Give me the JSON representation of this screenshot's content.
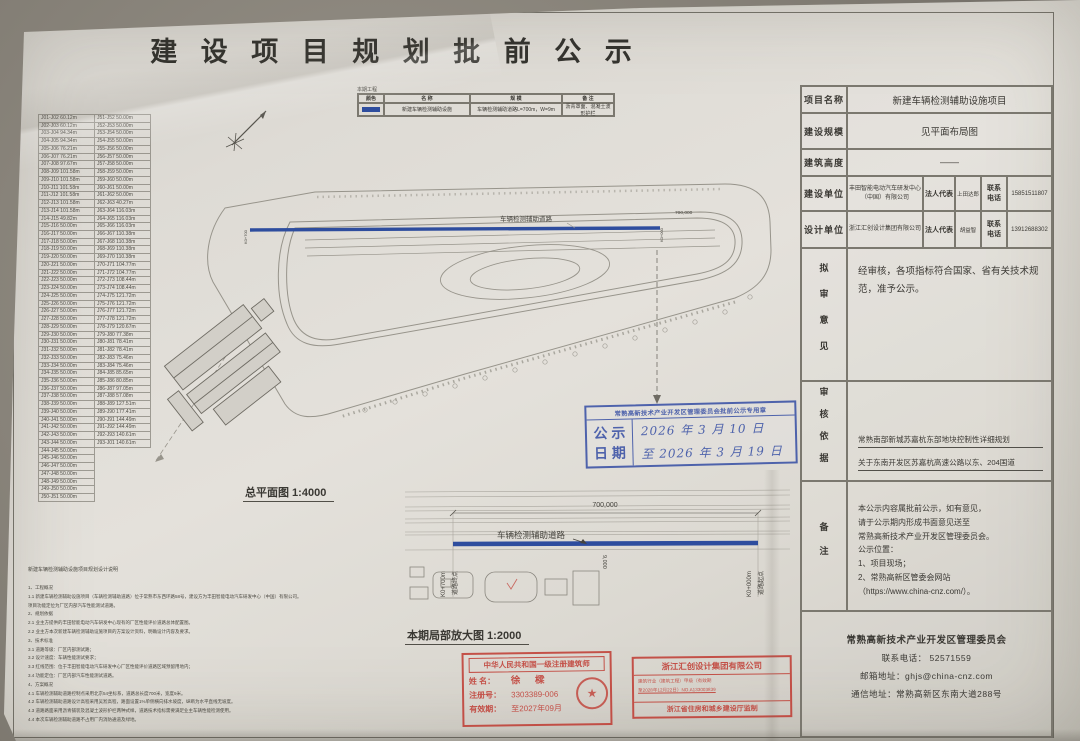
{
  "page": {
    "title": "建 设 项 目 规 划 批 前 公 示"
  },
  "colors": {
    "blue": "#2e4d9e",
    "red": "#c03a31",
    "ink": "#3b3934"
  },
  "legend": {
    "caption": "本期工程",
    "headers": [
      "颜色",
      "名 称",
      "规 模",
      "备 注"
    ],
    "row": {
      "name": "新建车辆检测辅助设施",
      "scale": "车辆检测辅助道路L=700m，W=9m",
      "remark": "沥青罩面、混凝土波形护栏"
    }
  },
  "coords": {
    "rows": [
      [
        "J01-J02 60.12m",
        "J51-J52 50.00m"
      ],
      [
        "J02-J03 60.12m",
        "J52-J53 50.00m"
      ],
      [
        "J03-J04 94.34m",
        "J53-J54 50.00m"
      ],
      [
        "J04-J05 94.34m",
        "J54-J55 50.00m"
      ],
      [
        "J05-J06 76.21m",
        "J55-J56 50.00m"
      ],
      [
        "J06-J07 76.21m",
        "J56-J57 50.00m"
      ],
      [
        "J07-J08 97.67m",
        "J57-J58 50.00m"
      ],
      [
        "J08-J09 101.58m",
        "J58-J59 50.00m"
      ],
      [
        "J09-J10 101.58m",
        "J59-J60 50.00m"
      ],
      [
        "J10-J11 101.58m",
        "J60-J61 50.00m"
      ],
      [
        "J11-J12 101.58m",
        "J61-J62 50.00m"
      ],
      [
        "J12-J13 101.58m",
        "J62-J63 40.27m"
      ],
      [
        "J13-J14 101.58m",
        "J63-J64 116.03m"
      ],
      [
        "J14-J15 49.82m",
        "J64-J65 116.03m"
      ],
      [
        "J15-J16 50.00m",
        "J65-J66 116.03m"
      ],
      [
        "J16-J17 50.00m",
        "J66-J67 110.38m"
      ],
      [
        "J17-J18 50.00m",
        "J67-J68 110.38m"
      ],
      [
        "J18-J19 50.00m",
        "J68-J69 110.38m"
      ],
      [
        "J19-J20 50.00m",
        "J69-J70 110.38m"
      ],
      [
        "J20-J21 50.00m",
        "J70-J71 104.77m"
      ],
      [
        "J21-J22 50.00m",
        "J71-J72 104.77m"
      ],
      [
        "J22-J23 50.00m",
        "J72-J73 108.44m"
      ],
      [
        "J23-J24 50.00m",
        "J73-J74 108.44m"
      ],
      [
        "J24-J25 50.00m",
        "J74-J75 121.72m"
      ],
      [
        "J25-J26 50.00m",
        "J75-J76 121.72m"
      ],
      [
        "J26-J27 50.00m",
        "J76-J77 121.72m"
      ],
      [
        "J27-J28 50.00m",
        "J77-J78 121.72m"
      ],
      [
        "J28-J29 50.00m",
        "J78-J79 120.67m"
      ],
      [
        "J29-J30 50.00m",
        "J79-J80 77.38m"
      ],
      [
        "J30-J31 50.00m",
        "J80-J81 78.41m"
      ],
      [
        "J31-J32 50.00m",
        "J81-J82 78.41m"
      ],
      [
        "J32-J33 50.00m",
        "J82-J83 75.46m"
      ],
      [
        "J33-J34 50.00m",
        "J83-J84 75.46m"
      ],
      [
        "J34-J35 50.00m",
        "J84-J85 85.65m"
      ],
      [
        "J35-J36 50.00m",
        "J85-J86 80.85m"
      ],
      [
        "J36-J37 50.00m",
        "J86-J87 97.05m"
      ],
      [
        "J37-J38 50.00m",
        "J87-J88 57.08m"
      ],
      [
        "J38-J39 50.00m",
        "J88-J89 127.51m"
      ],
      [
        "J39-J40 50.00m",
        "J89-J90 177.41m"
      ],
      [
        "J40-J41 50.00m",
        "J90-J91 144.49m"
      ],
      [
        "J41-J42 50.00m",
        "J91-J92 144.49m"
      ],
      [
        "J42-J43 50.00m",
        "J92-J93 140.61m"
      ],
      [
        "J43-J44 50.00m",
        "J93-J01 140.61m"
      ],
      [
        "J44-J45 50.00m",
        ""
      ],
      [
        "J45-J46 50.00m",
        ""
      ],
      [
        "J46-J47 50.00m",
        ""
      ],
      [
        "J47-J48 50.00m",
        ""
      ],
      [
        "J48-J49 50.00m",
        ""
      ],
      [
        "J49-J50 50.00m",
        ""
      ],
      [
        "J50-J51 50.00m",
        ""
      ]
    ]
  },
  "site_plan": {
    "caption": "总平面图 1:4000",
    "road_label": "车辆检测辅助道路",
    "dim": "700,000",
    "end": "K0+700",
    "start": "K0+000"
  },
  "detail_plan": {
    "caption": "本期局部放大图 1:2000",
    "road_label": "车辆检测辅助道路",
    "dim_length": "700,000",
    "dim_width": "9,000",
    "end_station": "K0+700m",
    "end_label": "道路终点",
    "start_station": "K0+000m",
    "start_label": "道路起点"
  },
  "notes": {
    "title": "新建车辆检测辅助设施项目规划设计说明",
    "lines": [
      "1、工程概况",
      "1.1 新建车辆检测辅助设施项目（车辆检测辅助道路）位于常熟市东西环路58号，建设方为丰田智能电动汽车研发中心（中国）有限公司。",
      "项目功能定位为厂区内部汽车性能测试道路。",
      "2、规划依据",
      "2.1 业主方提供的丰田智能电动汽车研发中心现有的厂区性能评价道路总体配置图。",
      "2.2 业主方本次新建车辆检测辅助设施项目的方案设计资料，明确设计内容及要求。",
      "3、技术标准",
      "3.1 道路等级：厂区内部测试路；",
      "3.2 设计速度：车辆性能测试要求；",
      "3.3 红线范围：位于丰田智能电动汽车研发中心厂区性能评价道路区域预留用地内；",
      "3.4 功能定位：厂区内部汽车性能测试道路。",
      "4、方案概况",
      "4.1 车辆检测辅助道路控制点采用北京54坐标系，道路总长度700米，宽度9米。",
      "4.2 车辆检测辅助道路设计高程采用吴淞高程，路面设置1%单侧横向排水坡度，纵断为水平直线无坡度。",
      "4.3 道路路面采用沥青铺装及混凝土波形护栏两种式样，道路技术指标需要满足业主车辆性能检测使用。",
      "4.4 本次车辆检测辅助道路不占用厂内消防通道及绿地。"
    ]
  },
  "info_table": {
    "project_name_label": "项目名称",
    "project_name": "新建车辆检测辅助设施项目",
    "scale_label": "建设规模",
    "scale": "见平面布局图",
    "height_label": "建筑高度",
    "height": "——",
    "builder_label": "建设单位",
    "builder": "丰田智能电动汽车研发中心（中国）有限公司",
    "builder_rep_label": "法人代表",
    "builder_rep": "上田达郎",
    "builder_tel_label": "联系\n电话",
    "builder_tel": "15851511807",
    "designer_label": "设计单位",
    "designer": "浙江汇创设计集团有限公司",
    "designer_rep_label": "法人代表",
    "designer_rep": "胡益智",
    "designer_tel_label": "联系\n电话",
    "designer_tel": "13912688302",
    "opinion_label": "拟审意见",
    "opinion": "经审核，各项指标符合国家、省有关技术规范，准予公示。",
    "basis_label": "审核依据",
    "basis_lines": [
      "常熟南部新城苏嘉杭东部地块控制性详细规划",
      "关于东南开发区苏嘉杭高速公路以东、204国道",
      "以南地块的规划设计条件 常规设[2010]144号，等"
    ],
    "note_label": "备注",
    "note_lines": [
      "本公示内容属批前公示，如有意见，",
      "请于公示期内形成书面意见送至",
      "常熟高新技术产业开发区管理委员会。",
      "公示位置：",
      "1、项目现场；",
      "2、常熟高新区管委会网站",
      "（https://www.china-cnz.com/）。"
    ],
    "footer": {
      "org": "常熟高新技术产业开发区管理委员会",
      "tel": "联系电话：  52571559",
      "email": "邮箱地址：ghjs@china-cnz.com",
      "address": "通信地址：常熟高新区东南大道288号"
    }
  },
  "blue_stamp": {
    "header": "常熟高新技术产业开发区管理委员会批前公示专用章",
    "left_line1": "公 示",
    "left_line2": "日 期",
    "date_line1": "2026 年 3 月 10 日",
    "date_line2": "至 2026 年 3 月 19 日"
  },
  "stamps": {
    "architect": {
      "header": "中华人民共和国一级注册建筑师",
      "name_label": "姓 名：",
      "name": "徐 樑",
      "reg_label": "注册号：",
      "reg": "3303389-006",
      "valid_label": "有效期：",
      "valid": "至2027年09月",
      "seal_glyph": "★"
    },
    "company": {
      "header": "浙江汇创设计集团有限公司",
      "cert_line1": "建筑行业（建筑工程）甲级（有效期",
      "cert_line2": "至2028年12月22日）NO.A133003839",
      "footer": "浙江省住房和城乡建设厅监制"
    }
  }
}
